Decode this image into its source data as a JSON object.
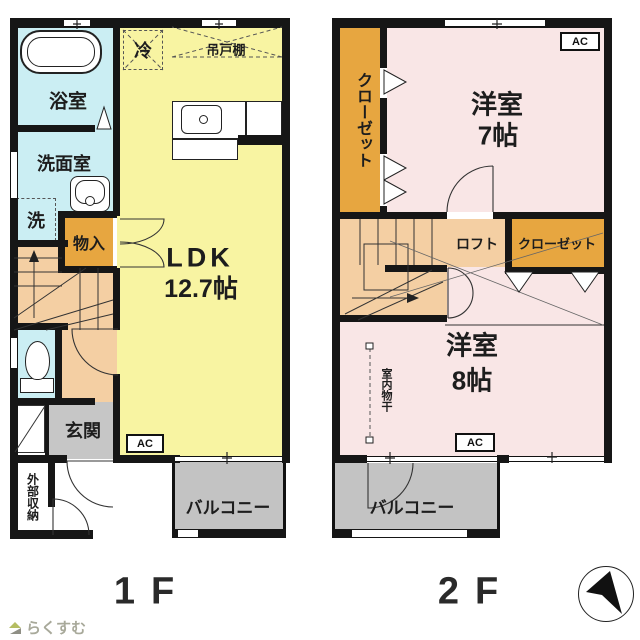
{
  "floorplan": {
    "f1": {
      "label": "1F",
      "bath": "浴室",
      "washroom": "洗面室",
      "laundry": "洗",
      "fridge": "冷",
      "cupboard": "吊戸棚",
      "storage": "物入",
      "ldk_name": "LDK",
      "ldk_size": "12.7帖",
      "entrance": "玄関",
      "outer_storage": "外部収納",
      "balcony": "バルコニー",
      "ac": "AC"
    },
    "f2": {
      "label": "2F",
      "closet_left": "クローゼット",
      "room7_name": "洋室",
      "room7_size": "7帖",
      "loft": "ロフト",
      "closet_right": "クローゼット",
      "room8_name": "洋室",
      "room8_size": "8帖",
      "indoor_drying": "室内物干",
      "balcony": "バルコニー",
      "ac_top": "AC",
      "ac_bottom": "AC"
    }
  },
  "footer": {
    "logo_text": "らくすむ"
  },
  "colors": {
    "wall": "#161616",
    "water": "#cbeef3",
    "ldk": "#f8f4a2",
    "stairs": "#f4cfa3",
    "closet": "#e7a640",
    "room": "#f9e6e6",
    "gray": "#c6c6c6",
    "balcony": "#c3c3c3",
    "line": "#333333",
    "logo_text": "#a8a99a",
    "logo_green": "#b5bd62"
  }
}
